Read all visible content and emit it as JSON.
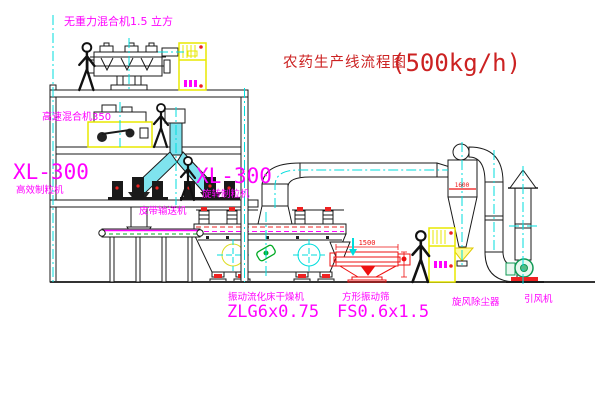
{
  "title": {
    "name": "农药生产线流程图",
    "capacity": "(500kg/h)"
  },
  "labels": {
    "zero_gravity_mixer": "无重力混合机1.5 立方",
    "high_speed_mixer": "高速混合机350",
    "left_granulator_model": "XL-300",
    "left_granulator_name": "高效制粒机",
    "right_granulator_model": "XL-300",
    "right_granulator_name": "旋转制粒机",
    "belt_conveyor": "皮带输送机",
    "fluid_bed_dryer_name": "振动流化床干燥机",
    "fluid_bed_dryer_model": "ZLG6x0.75",
    "vibrating_screen_name": "方形振动筛",
    "vibrating_screen_model": "FS0.6x1.5",
    "cyclone": "旋风除尘器",
    "induced_draft_fan": "引风机"
  },
  "dims": {
    "screen_length": "1500",
    "cyclone_level": "1600"
  },
  "colors": {
    "label_magenta": "#FF00FF",
    "title_red": "#CC2222",
    "centerline_cyan": "#00DDDD",
    "cabinet_yellow": "#E8E800",
    "line_black": "#1A1A1A",
    "accent_red": "#EE2222",
    "accent_green": "#00AA22"
  }
}
